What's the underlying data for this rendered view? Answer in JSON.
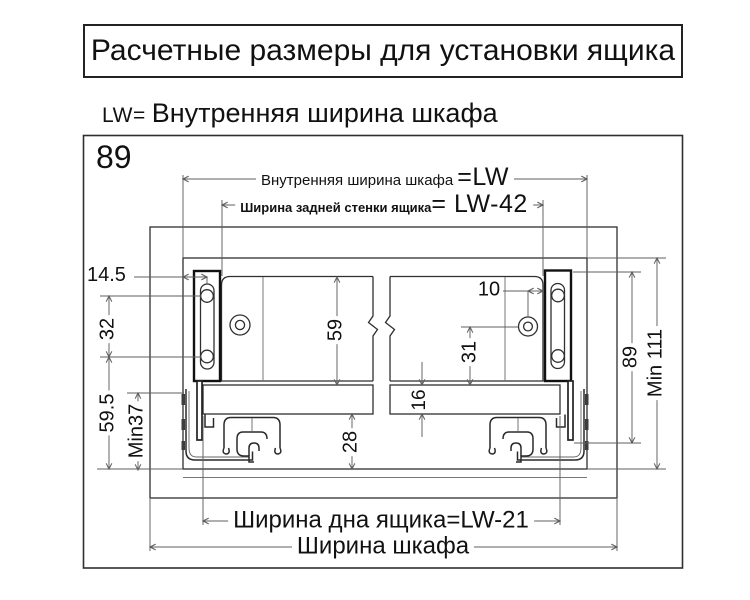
{
  "title": "Расчетные размеры для установки ящика",
  "subtitle": {
    "lw": "LW=",
    "text": "Внутренняя ширина шкафа"
  },
  "diagram": {
    "corner_label": "89",
    "top_dims": {
      "inner_width_label": "Внутренняя ширина шкафа",
      "inner_width_value": "=LW",
      "back_width_label": "Ширина задней стенки ящика",
      "back_width_value": "= LW-42"
    },
    "bottom_dims": {
      "drawer_bottom_label": "Ширина дна ящика",
      "drawer_bottom_value": "=LW-21",
      "cabinet_width_label": "Ширина шкафа"
    },
    "side_dims": {
      "hole_offset": "14.5",
      "hole_spacing": "32",
      "lower_height": "59.5",
      "rail_min_clearance": "Min37",
      "back_height": "59",
      "rail_height": "28",
      "bottom_thickness": "16",
      "hole_to_bottom": "31",
      "hole_edge_offset": "10",
      "system_height": "89",
      "min_inner_height": "Min 111"
    }
  }
}
